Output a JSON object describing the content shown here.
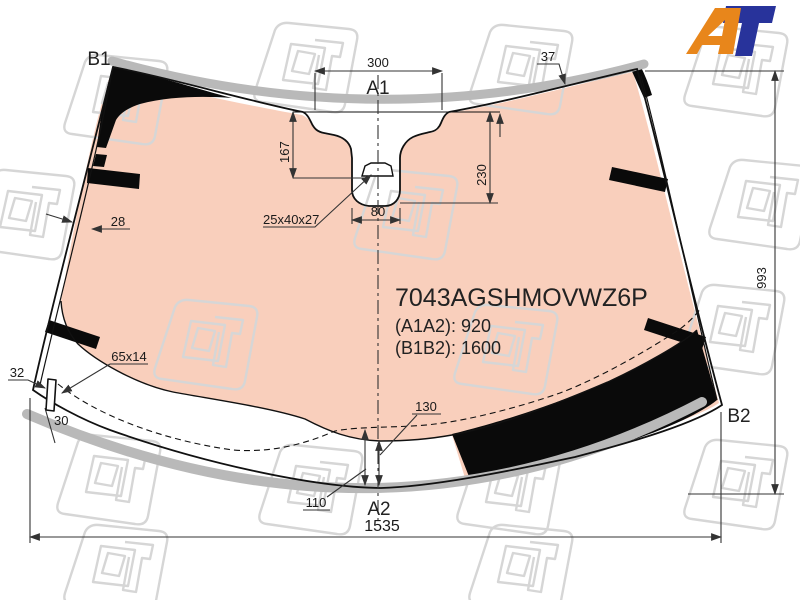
{
  "logo": {
    "a": "A",
    "t": "T",
    "orange": "#E8861B",
    "blue": "#28339B"
  },
  "labels": {
    "a1": "A1",
    "a2": "A2",
    "b1": "B1",
    "b2": "B2"
  },
  "dimensions": {
    "top_width": "300",
    "molding_width": "37",
    "camera_height": "167",
    "cutout_height": "230",
    "slot_width": "80",
    "bracket_size": "25x40x27",
    "edge_strip": "28",
    "side_height": "993",
    "button_size": "65x14",
    "button_offset": "32",
    "button_height": "30",
    "tint_band_left": "110",
    "tint_band_right": "130",
    "bottom_width": "1535"
  },
  "part": {
    "number": "7043AGSHMOVWZ6P",
    "a1a2": "(A1A2): 920",
    "b1b2": "(B1B2): 1600"
  },
  "colors": {
    "tint": "#F9CFBC",
    "frit_black": "#0a0a0a",
    "molding_gray": "#b9b9b9",
    "watermark_gray": "#d6d6d6",
    "line": "#333333"
  }
}
